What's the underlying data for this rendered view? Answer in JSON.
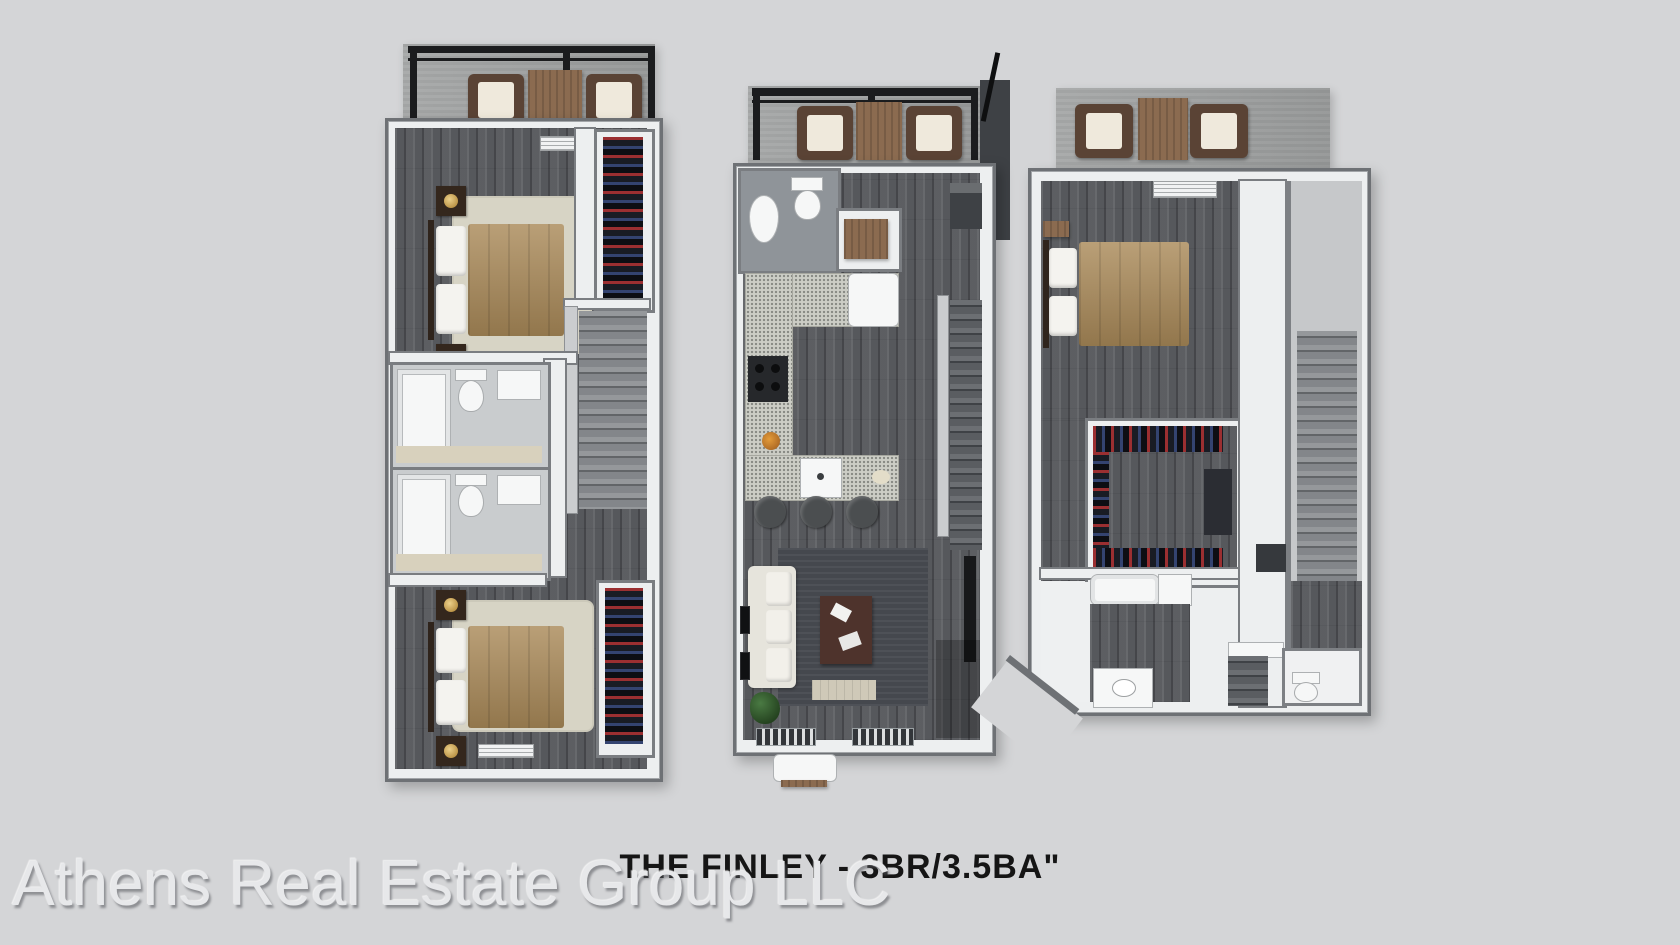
{
  "page": {
    "background_color": "#d4d5d7",
    "type": "3d-floor-plan-rendering"
  },
  "title": {
    "text": "THE FINLEY - 3BR/3.5BA\""
  },
  "watermark": {
    "text": "Athens Real Estate Group LLC"
  },
  "colors": {
    "background": "#d4d5d7",
    "wall_fill": "#edeff0",
    "wall_edge": "#6e7175",
    "wood_floor": "#56585c",
    "concrete": "#a2a4a4",
    "pergola_black": "#1b1c1e",
    "bed_comforter_tan": "#aa8a59",
    "rug_beige": "#d7d4c5",
    "rug_dark": "#45484e",
    "furniture_wood": "#8b6b50",
    "sofa_cream": "#e6e4dc",
    "coffee_table_brown": "#4e332c",
    "clothes_red": "#aa3234",
    "clothes_navy": "#3a4c80",
    "title_text": "#151515",
    "watermark_text": "#e7e8ea"
  },
  "plans": [
    {
      "name": "left-bedroom-level",
      "rooms": [
        "balcony-with-pergola",
        "bedroom-1",
        "closet-1",
        "stairs",
        "bathroom-1",
        "bathroom-2",
        "bedroom-2",
        "closet-2"
      ]
    },
    {
      "name": "middle-main-level",
      "rooms": [
        "balcony-with-pergola",
        "powder-room",
        "entry-closet",
        "kitchen",
        "stairs",
        "living-room"
      ]
    },
    {
      "name": "right-entry-level",
      "rooms": [
        "patio",
        "bedroom-3",
        "walk-in-closet",
        "bathroom-3",
        "staircase-corridor",
        "water-closet"
      ]
    }
  ]
}
